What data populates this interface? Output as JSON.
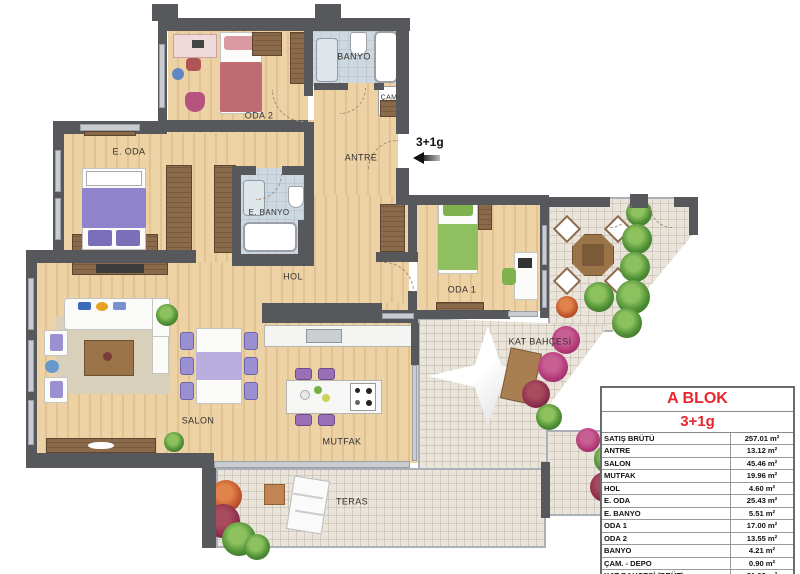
{
  "legend": {
    "block_title": "A BLOK",
    "unit_type": "3+1g",
    "rows": [
      {
        "label": "SATIŞ BRÜTÜ",
        "value": "257.01 m²"
      },
      {
        "label": "ANTRE",
        "value": "13.12 m²"
      },
      {
        "label": "SALON",
        "value": "45.46 m²"
      },
      {
        "label": "MUTFAK",
        "value": "19.96 m²"
      },
      {
        "label": "HOL",
        "value": "4.60 m²"
      },
      {
        "label": "E. ODA",
        "value": "25.43 m²"
      },
      {
        "label": "E. BANYO",
        "value": "5.51 m²"
      },
      {
        "label": "ODA 1",
        "value": "17.00 m²"
      },
      {
        "label": "ODA 2",
        "value": "13.55 m²"
      },
      {
        "label": "BANYO",
        "value": "4.21 m²"
      },
      {
        "label": "ÇAM. - DEPO",
        "value": "0.90 m²"
      },
      {
        "label": "KAT BAHÇESİ (BRÜT)",
        "value": "31.92 m²"
      },
      {
        "label": "TERAS (BRÜT)",
        "value": "22.93 m²"
      }
    ]
  },
  "plan": {
    "rooms": {
      "oda2": "ODA 2",
      "banyo": "BANYO",
      "cam": "ÇAM",
      "antre": "ANTRE",
      "e_oda": "E. ODA",
      "e_banyo": "E. BANYO",
      "hol": "HOL",
      "oda1": "ODA 1",
      "kat_bahcesi": "KAT BAHÇESİ",
      "salon": "SALON",
      "mutfak": "MUTFAK",
      "teras": "TERAS"
    },
    "entry": {
      "label": "3+1g"
    }
  },
  "colors": {
    "wall": "#57585c",
    "wood_floor": "#edd2a6",
    "bath_floor": "#cdd8e0",
    "outdoor_tile": "#eae4da",
    "accent_red": "#e8262c",
    "bed_purple": "#8f84cc",
    "bed_pink": "#c06a72",
    "bed_green": "#8fbf5f",
    "plant_green": "#4e8f35"
  }
}
